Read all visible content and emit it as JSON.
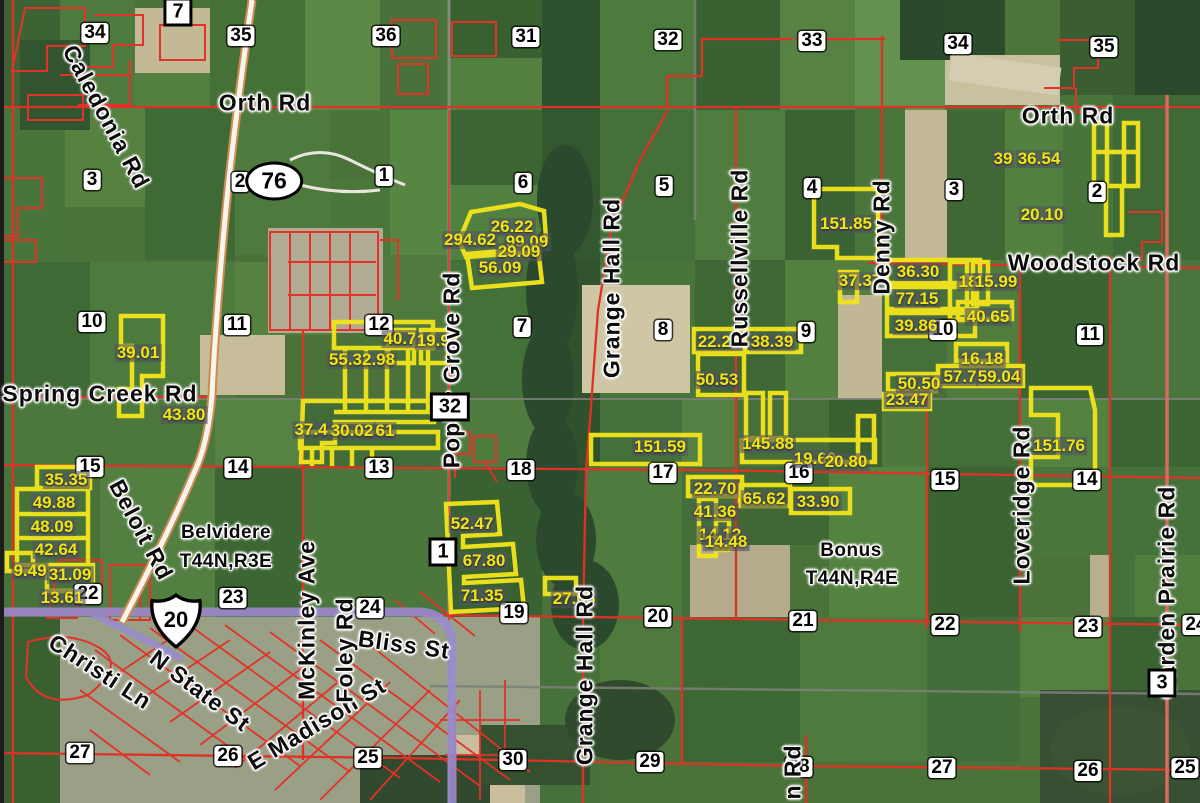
{
  "map_title": "Aerial plat map",
  "townships": [
    {
      "t": "Belvidere",
      "x": 226,
      "y": 533
    },
    {
      "t": "T44N,R3E",
      "x": 226,
      "y": 562
    },
    {
      "t": "Bonus",
      "x": 851,
      "y": 551
    },
    {
      "t": "T44N,R4E",
      "x": 852,
      "y": 579
    }
  ],
  "shields": {
    "us": {
      "label": "20",
      "x": 176,
      "y": 621
    },
    "oval": {
      "label": "76",
      "x": 274,
      "y": 181
    }
  },
  "route_boxes": [
    {
      "n": "7",
      "x": 178,
      "y": 12
    },
    {
      "n": "32",
      "x": 450,
      "y": 407
    },
    {
      "n": "1",
      "x": 443,
      "y": 552
    },
    {
      "n": "3",
      "x": 1162,
      "y": 683
    }
  ],
  "roads": [
    {
      "t": "Orth Rd",
      "x": 265,
      "y": 103,
      "r": 0
    },
    {
      "t": "Orth Rd",
      "x": 1068,
      "y": 116,
      "r": 0
    },
    {
      "t": "Woodstock Rd",
      "x": 1094,
      "y": 263,
      "r": 0
    },
    {
      "t": "Spring Creek Rd",
      "x": 100,
      "y": 394,
      "r": 0
    },
    {
      "t": "Bliss St",
      "x": 404,
      "y": 645,
      "r": 8
    },
    {
      "t": "Caledonia Rd",
      "x": 106,
      "y": 117,
      "r": 62
    },
    {
      "t": "Beloit Rd",
      "x": 141,
      "y": 530,
      "r": 62
    },
    {
      "t": "Christi Ln",
      "x": 100,
      "y": 672,
      "r": 33
    },
    {
      "t": "N State St",
      "x": 200,
      "y": 691,
      "r": 37
    },
    {
      "t": "E Madison St",
      "x": 317,
      "y": 724,
      "r": -31
    },
    {
      "t": "McKinley Ave",
      "x": 307,
      "y": 620,
      "r": -90
    },
    {
      "t": "Foley Rd",
      "x": 345,
      "y": 650,
      "r": -90
    },
    {
      "t": "Poplar Grove Rd",
      "x": 452,
      "y": 370,
      "r": -90
    },
    {
      "t": "Grange Hall Rd",
      "x": 612,
      "y": 288,
      "r": -90
    },
    {
      "t": "Grange Hall Rd",
      "x": 585,
      "y": 675,
      "r": -90
    },
    {
      "t": "Russellville Rd",
      "x": 740,
      "y": 258,
      "r": -90
    },
    {
      "t": "Denny Rd",
      "x": 882,
      "y": 237,
      "r": -90
    },
    {
      "t": "Loveridge Rd",
      "x": 1022,
      "y": 505,
      "r": -90
    },
    {
      "t": "Garden Prairie Rd",
      "x": 1167,
      "y": 592,
      "r": -90
    },
    {
      "t": "n Rd",
      "x": 793,
      "y": 772,
      "r": -90
    }
  ],
  "sections": [
    {
      "n": "34",
      "x": 95,
      "y": 33
    },
    {
      "n": "35",
      "x": 241,
      "y": 36
    },
    {
      "n": "36",
      "x": 386,
      "y": 36
    },
    {
      "n": "31",
      "x": 526,
      "y": 37
    },
    {
      "n": "32",
      "x": 668,
      "y": 40
    },
    {
      "n": "33",
      "x": 812,
      "y": 41
    },
    {
      "n": "34",
      "x": 958,
      "y": 44
    },
    {
      "n": "35",
      "x": 1104,
      "y": 47
    },
    {
      "n": "3",
      "x": 92,
      "y": 180
    },
    {
      "n": "2",
      "x": 240,
      "y": 182
    },
    {
      "n": "1",
      "x": 384,
      "y": 176
    },
    {
      "n": "6",
      "x": 523,
      "y": 183
    },
    {
      "n": "5",
      "x": 664,
      "y": 186
    },
    {
      "n": "4",
      "x": 812,
      "y": 188
    },
    {
      "n": "3",
      "x": 954,
      "y": 190
    },
    {
      "n": "2",
      "x": 1097,
      "y": 192
    },
    {
      "n": "10",
      "x": 92,
      "y": 322
    },
    {
      "n": "11",
      "x": 237,
      "y": 325
    },
    {
      "n": "12",
      "x": 379,
      "y": 325
    },
    {
      "n": "7",
      "x": 522,
      "y": 327
    },
    {
      "n": "8",
      "x": 663,
      "y": 330
    },
    {
      "n": "9",
      "x": 806,
      "y": 332
    },
    {
      "n": "10",
      "x": 943,
      "y": 330
    },
    {
      "n": "11",
      "x": 1090,
      "y": 335
    },
    {
      "n": "15",
      "x": 90,
      "y": 467
    },
    {
      "n": "14",
      "x": 238,
      "y": 468
    },
    {
      "n": "13",
      "x": 379,
      "y": 468
    },
    {
      "n": "18",
      "x": 521,
      "y": 470
    },
    {
      "n": "17",
      "x": 663,
      "y": 473
    },
    {
      "n": "16",
      "x": 799,
      "y": 473
    },
    {
      "n": "15",
      "x": 945,
      "y": 480
    },
    {
      "n": "14",
      "x": 1087,
      "y": 480
    },
    {
      "n": "22",
      "x": 88,
      "y": 594
    },
    {
      "n": "23",
      "x": 233,
      "y": 598
    },
    {
      "n": "24",
      "x": 370,
      "y": 608
    },
    {
      "n": "19",
      "x": 514,
      "y": 613
    },
    {
      "n": "20",
      "x": 658,
      "y": 617
    },
    {
      "n": "21",
      "x": 803,
      "y": 621
    },
    {
      "n": "22",
      "x": 945,
      "y": 625
    },
    {
      "n": "23",
      "x": 1088,
      "y": 627
    },
    {
      "n": "24",
      "x": 1196,
      "y": 625
    },
    {
      "n": "27",
      "x": 80,
      "y": 753
    },
    {
      "n": "26",
      "x": 228,
      "y": 756
    },
    {
      "n": "25",
      "x": 368,
      "y": 758
    },
    {
      "n": "30",
      "x": 513,
      "y": 760
    },
    {
      "n": "29",
      "x": 650,
      "y": 762
    },
    {
      "n": "28",
      "x": 799,
      "y": 767
    },
    {
      "n": "27",
      "x": 942,
      "y": 768
    },
    {
      "n": "26",
      "x": 1088,
      "y": 771
    },
    {
      "n": "25",
      "x": 1185,
      "y": 768
    }
  ],
  "parcels": [
    {
      "t": "39.01",
      "x": 138,
      "y": 353
    },
    {
      "t": "43.80",
      "x": 184,
      "y": 415
    },
    {
      "t": "55.32.98",
      "x": 362,
      "y": 360
    },
    {
      "t": "40.7",
      "x": 400,
      "y": 339
    },
    {
      "t": "19.97",
      "x": 438,
      "y": 341
    },
    {
      "t": "37.4",
      "x": 311,
      "y": 430
    },
    {
      "t": "30.02",
      "x": 352,
      "y": 431
    },
    {
      "t": "61",
      "x": 385,
      "y": 431
    },
    {
      "t": "26.22",
      "x": 512,
      "y": 227
    },
    {
      "t": "294.62",
      "x": 470,
      "y": 240
    },
    {
      "t": "99.09",
      "x": 527,
      "y": 242
    },
    {
      "t": "29.09",
      "x": 519,
      "y": 252
    },
    {
      "t": "56.09",
      "x": 500,
      "y": 268
    },
    {
      "t": "151.85",
      "x": 846,
      "y": 224
    },
    {
      "t": "37.37",
      "x": 860,
      "y": 281
    },
    {
      "t": "36.30",
      "x": 918,
      "y": 272
    },
    {
      "t": "77.15",
      "x": 917,
      "y": 299
    },
    {
      "t": "39.86",
      "x": 916,
      "y": 326
    },
    {
      "t": "18",
      "x": 968,
      "y": 282
    },
    {
      "t": "15.99",
      "x": 996,
      "y": 282
    },
    {
      "t": "40.65",
      "x": 988,
      "y": 317
    },
    {
      "t": "16.18",
      "x": 982,
      "y": 359
    },
    {
      "t": "57.7",
      "x": 960,
      "y": 377
    },
    {
      "t": "59.04",
      "x": 999,
      "y": 377
    },
    {
      "t": "50.50",
      "x": 919,
      "y": 384
    },
    {
      "t": "23.47",
      "x": 907,
      "y": 400
    },
    {
      "t": "22.24",
      "x": 719,
      "y": 342
    },
    {
      "t": "38.39",
      "x": 772,
      "y": 342
    },
    {
      "t": "50.53",
      "x": 717,
      "y": 380
    },
    {
      "t": "151.59",
      "x": 660,
      "y": 447
    },
    {
      "t": "145.88",
      "x": 768,
      "y": 444
    },
    {
      "t": "19.60",
      "x": 815,
      "y": 459
    },
    {
      "t": "20.80",
      "x": 846,
      "y": 462
    },
    {
      "t": "22.70",
      "x": 715,
      "y": 489
    },
    {
      "t": "65.62",
      "x": 764,
      "y": 499
    },
    {
      "t": "33.90",
      "x": 818,
      "y": 502
    },
    {
      "t": "41.36",
      "x": 715,
      "y": 512
    },
    {
      "t": "14.12",
      "x": 720,
      "y": 535
    },
    {
      "t": "14.48",
      "x": 726,
      "y": 542
    },
    {
      "t": "39",
      "x": 1003,
      "y": 159
    },
    {
      "t": "36.54",
      "x": 1039,
      "y": 159
    },
    {
      "t": "20.10",
      "x": 1042,
      "y": 215
    },
    {
      "t": "52.47",
      "x": 472,
      "y": 524
    },
    {
      "t": "67.80",
      "x": 484,
      "y": 561
    },
    {
      "t": "71.35",
      "x": 482,
      "y": 596
    },
    {
      "t": "27.05",
      "x": 574,
      "y": 599
    },
    {
      "t": "151.76",
      "x": 1059,
      "y": 446
    },
    {
      "t": "35.35",
      "x": 66,
      "y": 480
    },
    {
      "t": "49.88",
      "x": 54,
      "y": 503
    },
    {
      "t": "48.09",
      "x": 52,
      "y": 527
    },
    {
      "t": "42.64",
      "x": 56,
      "y": 550
    },
    {
      "t": "9.49",
      "x": 30,
      "y": 571
    },
    {
      "t": "31.09",
      "x": 70,
      "y": 575
    },
    {
      "t": "13.61",
      "x": 62,
      "y": 598
    }
  ],
  "colors": {
    "parcel_yellow": "#f0e31c",
    "road_red": "#e03127",
    "us20_purple": "#9a8bd0",
    "route76_casing": "#cd8a52",
    "section_chip": "#ffffff"
  }
}
